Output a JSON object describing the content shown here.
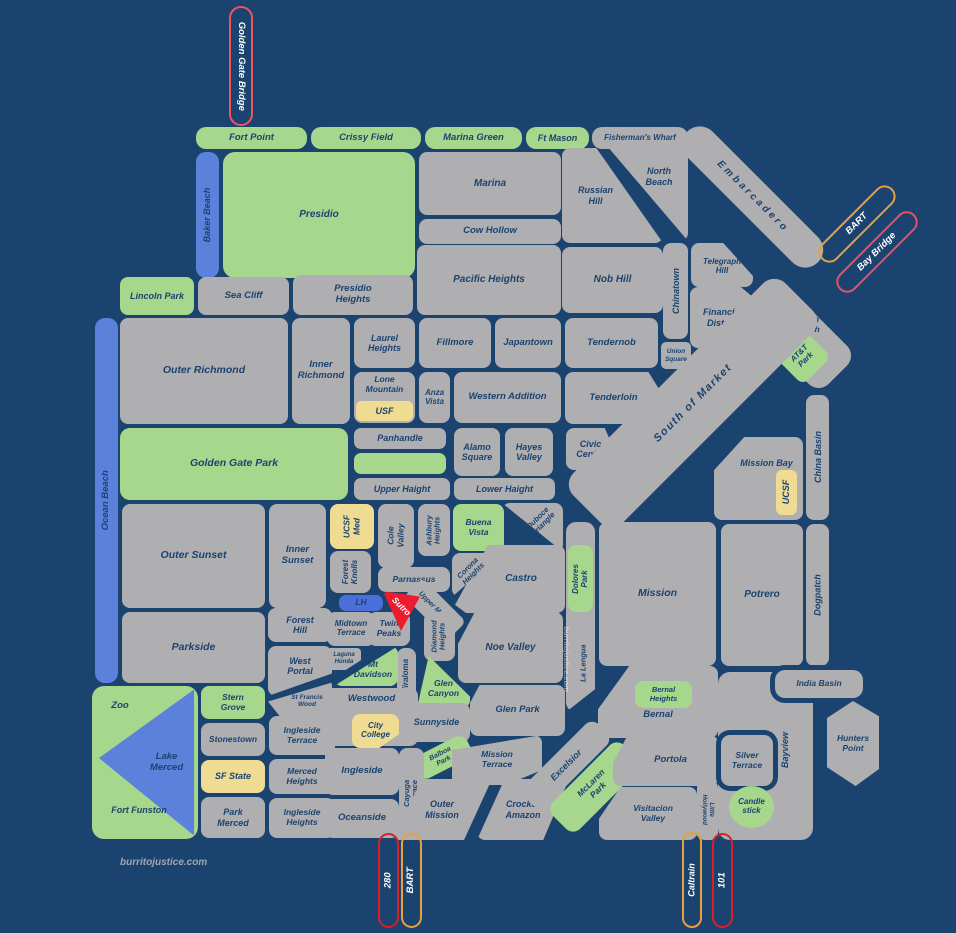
{
  "credit": "burritojustice.com",
  "colors": {
    "background_navy": "#1B4370",
    "block_gray": "#AFAEB0",
    "park_green": "#A6D78C",
    "water_blue": "#5B81DB",
    "campus_yellow": "#EFDB92",
    "sutro_red": "#EC1C2E",
    "lh_blue": "#4A6FD8",
    "ink_navy": "#1B4370",
    "bridge_red_outline": "#F0545C",
    "freeway_red_outline": "#DC1E26",
    "bart_orange_outline": "#E9A03C",
    "bay_bridge_outline": "#E94E63",
    "credit_gray": "#9FA8B2"
  },
  "labels": {
    "golden_gate_bridge": "Golden Gate Bridge",
    "fort_point": "Fort Point",
    "crissy_field": "Crissy Field",
    "marina_green": "Marina Green",
    "ft_mason": "Ft Mason",
    "fishermans_wharf": "Fisherman's Wharf",
    "baker_beach": "Baker Beach",
    "presidio": "Presidio",
    "marina": "Marina",
    "cow_hollow": "Cow Hollow",
    "russian_hill": "Russian Hill",
    "north_beach": "North Beach",
    "embarcadero": "Embarcadero",
    "bart_ne": "BART",
    "bay_bridge": "Bay Bridge",
    "telegraph_hill": "Telegraph Hill",
    "chinatown": "Chinatown",
    "nob_hill": "Nob Hill",
    "financial_district": "Financial District",
    "south_beach": "South Beach",
    "att_park": "AT&T Park",
    "union_square": "Union Square",
    "tendernob": "Tendernob",
    "tenderloin": "Tenderloin",
    "civic_center": "Civic Center",
    "japantown": "Japantown",
    "fillmore": "Fillmore",
    "pacific_heights": "Pacific Heights",
    "presidio_heights": "Presidio Heights",
    "sea_cliff": "Sea Cliff",
    "lincoln_park": "Lincoln Park",
    "outer_richmond": "Outer Richmond",
    "inner_richmond": "Inner Richmond",
    "laurel_heights": "Laurel Heights",
    "lone_mountain": "Lone Mountain",
    "usf": "USF",
    "anza_vista": "Anza Vista",
    "western_addition": "Western Addition",
    "alamo_square": "Alamo Square",
    "hayes_valley": "Hayes Valley",
    "panhandle": "Panhandle",
    "golden_gate_park": "Golden Gate Park",
    "upper_haight": "Upper Haight",
    "lower_haight": "Lower Haight",
    "south_of_market": "South of Market",
    "mission_bay": "Mission Bay",
    "ucsf_mission_bay": "UCSF",
    "china_basin": "China Basin",
    "ocean_beach": "Ocean Beach",
    "outer_sunset": "Outer Sunset",
    "inner_sunset": "Inner Sunset",
    "ucsf_med": "UCSF Med",
    "cole_valley": "Cole Valley",
    "ashbury_heights": "Ashbury Heights",
    "buena_vista": "Buena Vista",
    "duboce_triangle": "Duboce Triangle",
    "corona_heights": "Corona Heights",
    "castro": "Castro",
    "forest_knolls": "Forest Knolls",
    "parnassus": "Parnassus",
    "lh": "LH",
    "sutro": "Sutro",
    "midtown_terrace": "Midtown Terrace",
    "twin_peaks": "Twin Peaks",
    "upper_market": "Upper Market",
    "diamond_heights": "Diamond Heights",
    "laguna_honda": "Laguna Honda",
    "mt_davidson": "Mt Davidson",
    "miraloma": "Miraloma",
    "glen_canyon": "Glen Canyon",
    "noe_valley": "Noe Valley",
    "dolores_park": "Dolores Park",
    "mission": "Mission",
    "la_lengua": "La Lengua",
    "potrero": "Potrero",
    "dogpatch": "Dogpatch",
    "glen_park": "Glen Park",
    "bernal_heights": "Bernal Heights",
    "bernal": "Bernal",
    "india_basin": "India Basin",
    "parkside": "Parkside",
    "forest_hill": "Forest Hill",
    "west_portal": "West Portal",
    "st_francis_wood": "St Francis Wood",
    "westwood": "Westwood",
    "city_college": "City College",
    "sunnyside": "Sunnyside",
    "zoo": "Zoo",
    "stern_grove": "Stern Grove",
    "stonestown": "Stonestown",
    "lake_merced": "Lake Merced",
    "sf_state": "SF State",
    "fort_funston": "Fort Funston",
    "park_merced": "Park Merced",
    "merced_heights": "Merced Heights",
    "ingleside_terrace": "Ingleside Terrace",
    "ingleside": "Ingleside",
    "ingleside_heights": "Ingleside Heights",
    "oceanside": "Oceanside",
    "balboa_park": "Balboa Park",
    "cayuga_terrace": "Cayuga Terrace",
    "outer_mission": "Outer Mission",
    "crocker_amazon": "Crocker Amazon",
    "mission_terrace": "Mission Terrace",
    "excelsior": "Excelsior",
    "mclaren_park": "McLaren Park",
    "portola": "Portola",
    "visitacion_valley": "Visitacion Valley",
    "little_hollywood": "Little Hollywood",
    "silver_terrace": "Silver Terrace",
    "bayview": "Bayview",
    "hunters_point": "Hunters Point",
    "candlestick": "Candle stick",
    "i280": "280",
    "bart_south": "BART",
    "caltrain": "Caltrain",
    "i101": "101"
  }
}
